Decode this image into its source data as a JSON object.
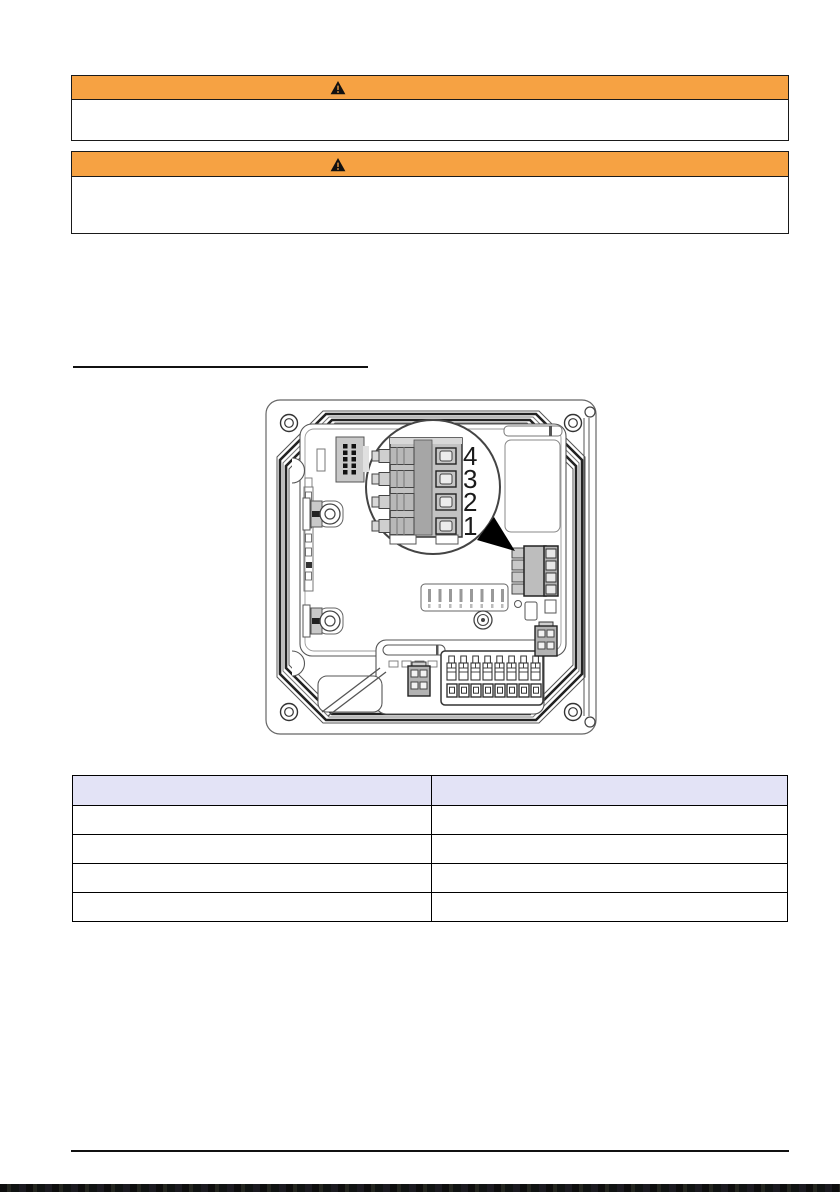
{
  "page": {
    "background": "#ffffff"
  },
  "colors": {
    "warning_header": "#f6a243",
    "banner_border": "#1a1a1a",
    "table_header_fill": "#e3e3f6",
    "table_border": "#000000",
    "drawing_stroke": "#333333"
  },
  "banners": [
    {
      "icon": "warning-triangle",
      "header_text": "",
      "body_text": ""
    },
    {
      "icon": "warning-triangle",
      "header_text": "",
      "body_text": ""
    }
  ],
  "section_link": {
    "text": ""
  },
  "figure": {
    "type": "technical-illustration",
    "callout_labels": [
      "4",
      "3",
      "2",
      "1"
    ],
    "magnified_terminal_count": 4,
    "bottom_terminal_count": 8
  },
  "table": {
    "columns": [
      "",
      ""
    ],
    "rows": [
      [
        "",
        ""
      ],
      [
        "",
        ""
      ],
      [
        "",
        ""
      ],
      [
        "",
        ""
      ]
    ]
  }
}
